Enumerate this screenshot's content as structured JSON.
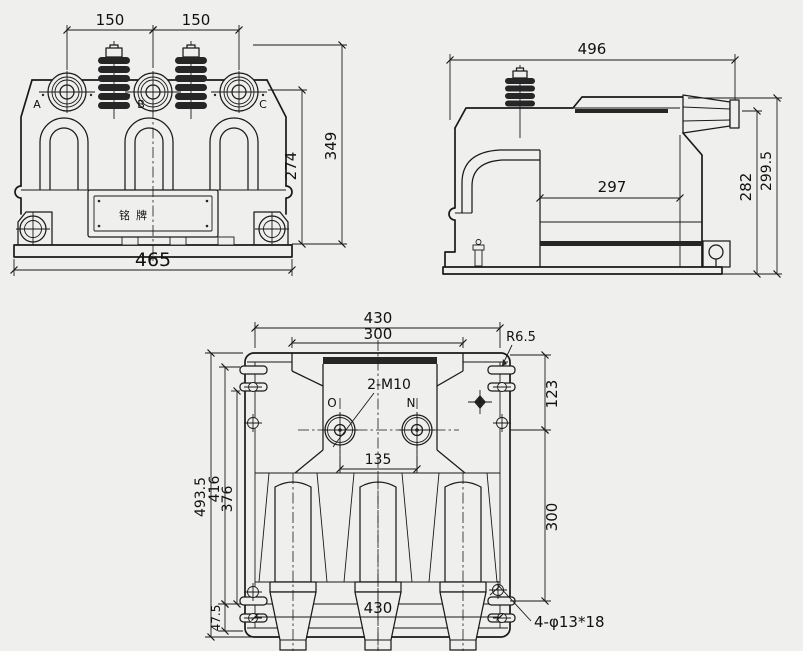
{
  "colors": {
    "background": "#efefed",
    "line": "#1a1a1a"
  },
  "front_view": {
    "dim_ab": "150",
    "dim_bc": "150",
    "dim_height_total": "349",
    "dim_height_body": "274",
    "dim_width_base": "465",
    "label_a": "A",
    "label_b": "B",
    "label_c": "C",
    "nameplate_text": "铭牌"
  },
  "side_view": {
    "dim_width_total": "496",
    "dim_width_body": "297",
    "dim_height_body": "282",
    "dim_height_total": "299.5"
  },
  "bottom_view": {
    "dim_width_top": "430",
    "dim_width_inner": "300",
    "dim_corner_radius": "R6.5",
    "dim_offset_right": "123",
    "label_thread": "2-M10",
    "label_o": "O",
    "label_n": "N",
    "dim_on_spacing": "135",
    "dim_h_total": "493.5",
    "dim_h2": "416",
    "dim_h3": "376",
    "dim_v_right": "300",
    "dim_h4": "47.5",
    "dim_width_bottom": "430",
    "label_slots": "4-φ13*18"
  }
}
